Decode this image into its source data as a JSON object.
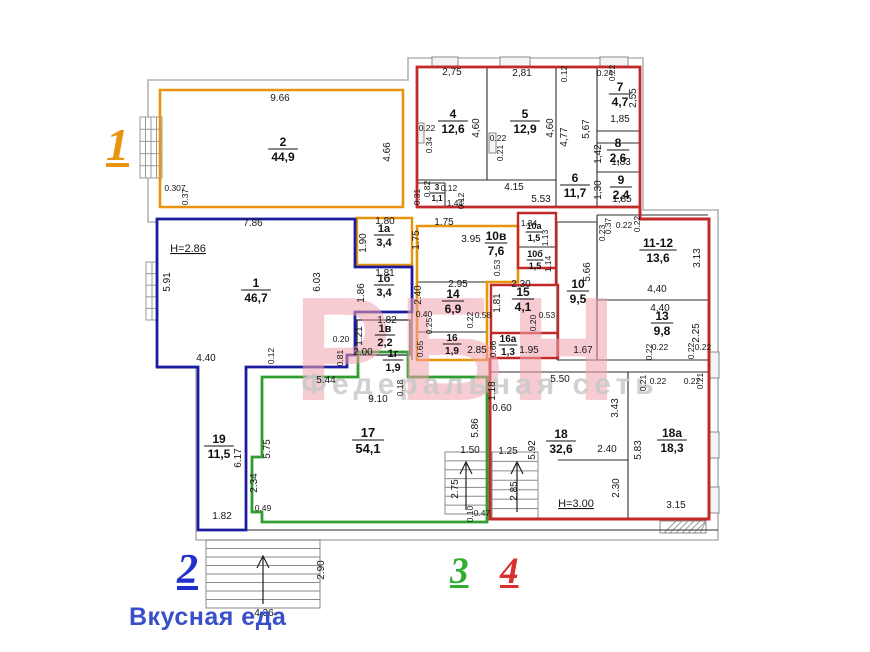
{
  "zones": [
    {
      "n": "1",
      "color": "#e8940c"
    },
    {
      "n": "2",
      "color": "#2230cc"
    },
    {
      "n": "3",
      "color": "#2fae2f"
    },
    {
      "n": "4",
      "color": "#d93030"
    }
  ],
  "brand": {
    "text": "Вкусная еда",
    "color": "#3a50c8"
  },
  "watermark": {
    "big": "РБН",
    "big_color": "#f2a2ae",
    "small": "Федеральная сеть",
    "small_color": "#c9c9c9"
  },
  "heights": [
    {
      "t": "H=2.86",
      "x": 188,
      "y": 252
    },
    {
      "t": "H=3.00",
      "x": 576,
      "y": 507
    }
  ],
  "rooms": [
    {
      "id": "2",
      "area": "44,9",
      "x": 283,
      "y": 146,
      "fs": 12
    },
    {
      "id": "1",
      "area": "46,7",
      "x": 256,
      "y": 287,
      "fs": 12
    },
    {
      "id": "1а",
      "area": "3,4",
      "x": 384,
      "y": 232,
      "fs": 11
    },
    {
      "id": "1б",
      "area": "3,4",
      "x": 384,
      "y": 282,
      "fs": 11
    },
    {
      "id": "1в",
      "area": "2,2",
      "x": 385,
      "y": 332,
      "fs": 11
    },
    {
      "id": "1г",
      "area": "1,9",
      "x": 393,
      "y": 357,
      "fs": 11
    },
    {
      "id": "3",
      "area": "1,1",
      "x": 437,
      "y": 190,
      "fs": 8
    },
    {
      "id": "4",
      "area": "12,6",
      "x": 453,
      "y": 118,
      "fs": 12
    },
    {
      "id": "5",
      "area": "12,9",
      "x": 525,
      "y": 118,
      "fs": 12
    },
    {
      "id": "6",
      "area": "11,7",
      "x": 575,
      "y": 182,
      "fs": 12
    },
    {
      "id": "7",
      "area": "4,7",
      "x": 620,
      "y": 91,
      "fs": 12
    },
    {
      "id": "8",
      "area": "2,6",
      "x": 618,
      "y": 147,
      "fs": 12
    },
    {
      "id": "9",
      "area": "2,4",
      "x": 621,
      "y": 184,
      "fs": 12
    },
    {
      "id": "10в",
      "area": "7,6",
      "x": 496,
      "y": 240,
      "fs": 12
    },
    {
      "id": "10а",
      "area": "1,5",
      "x": 534,
      "y": 229,
      "fs": 9
    },
    {
      "id": "10б",
      "area": "1,5",
      "x": 535,
      "y": 257,
      "fs": 9
    },
    {
      "id": "14",
      "area": "6,9",
      "x": 453,
      "y": 298,
      "fs": 12
    },
    {
      "id": "15",
      "area": "4,1",
      "x": 523,
      "y": 296,
      "fs": 12
    },
    {
      "id": "16",
      "area": "1,9",
      "x": 452,
      "y": 341,
      "fs": 10
    },
    {
      "id": "16а",
      "area": "1,3",
      "x": 508,
      "y": 342,
      "fs": 10
    },
    {
      "id": "10",
      "area": "9,5",
      "x": 578,
      "y": 288,
      "fs": 12
    },
    {
      "id": "11-12",
      "area": "13,6",
      "x": 658,
      "y": 247,
      "fs": 12
    },
    {
      "id": "13",
      "area": "9,8",
      "x": 662,
      "y": 320,
      "fs": 12
    },
    {
      "id": "17",
      "area": "54,1",
      "x": 368,
      "y": 437,
      "fs": 13
    },
    {
      "id": "19",
      "area": "11,5",
      "x": 219,
      "y": 443,
      "fs": 12
    },
    {
      "id": "18",
      "area": "32,6",
      "x": 561,
      "y": 438,
      "fs": 12
    },
    {
      "id": "18а",
      "area": "18,3",
      "x": 672,
      "y": 437,
      "fs": 12
    }
  ],
  "dims": [
    {
      "t": "9.66",
      "x": 280,
      "y": 101
    },
    {
      "t": "4.66",
      "x": 390,
      "y": 152,
      "r": 1
    },
    {
      "t": "0.307",
      "x": 175,
      "y": 191,
      "s": 1
    },
    {
      "t": "0.37",
      "x": 188,
      "y": 197,
      "r": 1,
      "s": 1
    },
    {
      "t": "2,75",
      "x": 452,
      "y": 75
    },
    {
      "t": "2,81",
      "x": 522,
      "y": 76
    },
    {
      "t": "4,60",
      "x": 479,
      "y": 128,
      "r": 1
    },
    {
      "t": "4,60",
      "x": 553,
      "y": 128,
      "r": 1
    },
    {
      "t": "0.22",
      "x": 427,
      "y": 131,
      "s": 1
    },
    {
      "t": "0.34",
      "x": 432,
      "y": 145,
      "r": 1,
      "s": 1
    },
    {
      "t": "0.22",
      "x": 498,
      "y": 141,
      "s": 1
    },
    {
      "t": "0.21",
      "x": 503,
      "y": 153,
      "r": 1,
      "s": 1
    },
    {
      "t": "4,77",
      "x": 567,
      "y": 137,
      "r": 1
    },
    {
      "t": "5,67",
      "x": 589,
      "y": 129,
      "r": 1
    },
    {
      "t": "4.15",
      "x": 514,
      "y": 190
    },
    {
      "t": "5.53",
      "x": 541,
      "y": 202
    },
    {
      "t": "0.24",
      "x": 605,
      "y": 76,
      "s": 1
    },
    {
      "t": "0.22",
      "x": 615,
      "y": 73,
      "r": 1,
      "s": 1
    },
    {
      "t": "0.12",
      "x": 567,
      "y": 74,
      "r": 1,
      "s": 1
    },
    {
      "t": "2,55",
      "x": 636,
      "y": 98,
      "r": 1
    },
    {
      "t": "1,85",
      "x": 620,
      "y": 122
    },
    {
      "t": "1,42",
      "x": 601,
      "y": 154,
      "r": 1
    },
    {
      "t": "1,83",
      "x": 621,
      "y": 165
    },
    {
      "t": "1,30",
      "x": 601,
      "y": 190,
      "r": 1
    },
    {
      "t": "1,85",
      "x": 622,
      "y": 202
    },
    {
      "t": "0.82",
      "x": 430,
      "y": 189,
      "r": 1,
      "s": 1
    },
    {
      "t": "0.31",
      "x": 420,
      "y": 197,
      "r": 1,
      "s": 1
    },
    {
      "t": "0.12",
      "x": 449,
      "y": 191,
      "s": 1
    },
    {
      "t": "0.12",
      "x": 464,
      "y": 201,
      "r": 1,
      "s": 1
    },
    {
      "t": "1,44",
      "x": 455,
      "y": 206,
      "s": 1
    },
    {
      "t": "7.86",
      "x": 253,
      "y": 226
    },
    {
      "t": "5.91",
      "x": 170,
      "y": 282,
      "r": 1
    },
    {
      "t": "6.03",
      "x": 320,
      "y": 282,
      "r": 1
    },
    {
      "t": "4.40",
      "x": 206,
      "y": 361
    },
    {
      "t": "0.12",
      "x": 274,
      "y": 356,
      "r": 1,
      "s": 1
    },
    {
      "t": "0.20",
      "x": 341,
      "y": 342,
      "s": 1
    },
    {
      "t": "0.81",
      "x": 343,
      "y": 358,
      "r": 1,
      "s": 1
    },
    {
      "t": "1.80",
      "x": 385,
      "y": 224
    },
    {
      "t": "1.90",
      "x": 366,
      "y": 243,
      "r": 1
    },
    {
      "t": "1.81",
      "x": 385,
      "y": 276
    },
    {
      "t": "1.86",
      "x": 364,
      "y": 293,
      "r": 1
    },
    {
      "t": "1.82",
      "x": 387,
      "y": 323
    },
    {
      "t": "1.21",
      "x": 362,
      "y": 336,
      "r": 1
    },
    {
      "t": "2.00",
      "x": 363,
      "y": 355
    },
    {
      "t": "1.75",
      "x": 444,
      "y": 225
    },
    {
      "t": "1.75",
      "x": 419,
      "y": 240,
      "r": 1
    },
    {
      "t": "3.95",
      "x": 471,
      "y": 242
    },
    {
      "t": "0.53",
      "x": 500,
      "y": 268,
      "r": 1,
      "s": 1
    },
    {
      "t": "1.34",
      "x": 529,
      "y": 226,
      "s": 1
    },
    {
      "t": "1.13",
      "x": 548,
      "y": 238,
      "r": 1,
      "s": 1
    },
    {
      "t": "1.14",
      "x": 551,
      "y": 264,
      "r": 1,
      "s": 1
    },
    {
      "t": "2.95",
      "x": 458,
      "y": 287
    },
    {
      "t": "2.40",
      "x": 421,
      "y": 295,
      "r": 1
    },
    {
      "t": "0.40",
      "x": 424,
      "y": 317,
      "s": 1
    },
    {
      "t": "0.25",
      "x": 432,
      "y": 326,
      "r": 1,
      "s": 1
    },
    {
      "t": "0.22",
      "x": 473,
      "y": 320,
      "r": 1,
      "s": 1
    },
    {
      "t": "0.58",
      "x": 483,
      "y": 318,
      "s": 1
    },
    {
      "t": "0.65",
      "x": 423,
      "y": 349,
      "r": 1,
      "s": 1
    },
    {
      "t": "2.85",
      "x": 477,
      "y": 353
    },
    {
      "t": "2.30",
      "x": 521,
      "y": 287
    },
    {
      "t": "1.81",
      "x": 500,
      "y": 303,
      "r": 1
    },
    {
      "t": "0.20",
      "x": 536,
      "y": 323,
      "r": 1,
      "s": 1
    },
    {
      "t": "0.53",
      "x": 547,
      "y": 318,
      "s": 1
    },
    {
      "t": "1.95",
      "x": 529,
      "y": 353
    },
    {
      "t": "0.66",
      "x": 496,
      "y": 349,
      "r": 1,
      "s": 1
    },
    {
      "t": "5.66",
      "x": 590,
      "y": 272,
      "r": 1
    },
    {
      "t": "1.67",
      "x": 583,
      "y": 353
    },
    {
      "t": "0.23",
      "x": 605,
      "y": 233,
      "r": 1,
      "s": 1
    },
    {
      "t": "0.37",
      "x": 611,
      "y": 226,
      "r": 1,
      "s": 1
    },
    {
      "t": "0.22",
      "x": 624,
      "y": 228,
      "s": 1
    },
    {
      "t": "0.22",
      "x": 640,
      "y": 224,
      "r": 1,
      "s": 1
    },
    {
      "t": "3.13",
      "x": 700,
      "y": 258,
      "r": 1
    },
    {
      "t": "4,40",
      "x": 657,
      "y": 292
    },
    {
      "t": "4,40",
      "x": 660,
      "y": 311
    },
    {
      "t": "2.25",
      "x": 699,
      "y": 333,
      "r": 1
    },
    {
      "t": "0.22",
      "x": 660,
      "y": 350,
      "s": 1
    },
    {
      "t": "0.22",
      "x": 652,
      "y": 352,
      "r": 1,
      "s": 1
    },
    {
      "t": "0.22",
      "x": 694,
      "y": 351,
      "r": 1,
      "s": 1
    },
    {
      "t": "0.22",
      "x": 703,
      "y": 350,
      "s": 1
    },
    {
      "t": "5.44",
      "x": 326,
      "y": 383
    },
    {
      "t": "9.10",
      "x": 378,
      "y": 402
    },
    {
      "t": "0.18",
      "x": 403,
      "y": 388,
      "r": 1,
      "s": 1
    },
    {
      "t": "5.75",
      "x": 270,
      "y": 449,
      "r": 1
    },
    {
      "t": "2.34",
      "x": 257,
      "y": 483,
      "r": 1
    },
    {
      "t": "0.49",
      "x": 263,
      "y": 511,
      "s": 1
    },
    {
      "t": "5.86",
      "x": 478,
      "y": 428,
      "r": 1
    },
    {
      "t": "6.17",
      "x": 241,
      "y": 458,
      "r": 1
    },
    {
      "t": "1.82",
      "x": 222,
      "y": 519
    },
    {
      "t": "1.50",
      "x": 470,
      "y": 453
    },
    {
      "t": "2.75",
      "x": 458,
      "y": 489,
      "r": 1
    },
    {
      "t": "1.25",
      "x": 508,
      "y": 454
    },
    {
      "t": "2.85",
      "x": 517,
      "y": 491,
      "r": 1
    },
    {
      "t": "0.10",
      "x": 473,
      "y": 514,
      "r": 1,
      "s": 1
    },
    {
      "t": "0.47",
      "x": 482,
      "y": 516,
      "s": 1
    },
    {
      "t": "5.50",
      "x": 560,
      "y": 382
    },
    {
      "t": "1.18",
      "x": 495,
      "y": 391,
      "r": 1
    },
    {
      "t": "0.60",
      "x": 502,
      "y": 411
    },
    {
      "t": "5.92",
      "x": 535,
      "y": 450,
      "r": 1
    },
    {
      "t": "3.43",
      "x": 618,
      "y": 408,
      "r": 1
    },
    {
      "t": "2.40",
      "x": 607,
      "y": 452
    },
    {
      "t": "2.30",
      "x": 619,
      "y": 488,
      "r": 1
    },
    {
      "t": "5.83",
      "x": 641,
      "y": 450,
      "r": 1
    },
    {
      "t": "3.15",
      "x": 676,
      "y": 508
    },
    {
      "t": "0.21",
      "x": 646,
      "y": 383,
      "r": 1,
      "s": 1
    },
    {
      "t": "0.22",
      "x": 658,
      "y": 384,
      "s": 1
    },
    {
      "t": "0.22",
      "x": 692,
      "y": 384,
      "s": 1
    },
    {
      "t": "0.21",
      "x": 703,
      "y": 381,
      "r": 1,
      "s": 1
    },
    {
      "t": "2.90",
      "x": 324,
      "y": 570,
      "r": 1
    },
    {
      "t": "4.36",
      "x": 264,
      "y": 616
    }
  ],
  "plan": {
    "outer": "M148,80 H408 V58 H643 V210 H718 V540 H196 V368 H157 V222 H148 Z",
    "outlines": [
      {
        "c": "#e8940c",
        "w": 2.6,
        "d": "M160,90 H403 V207 H160 Z"
      },
      {
        "c": "#e8940c",
        "w": 2.4,
        "d": "M357,218 H412 V265 H357 Z"
      },
      {
        "c": "#e8940c",
        "w": 2.6,
        "d": "M417,226 H518 V282 H487 V360 H417 Z"
      },
      {
        "c": "#1c1c9e",
        "w": 2.8,
        "d": "M157,219 H355 V267 H412 V312 H355 V355 H347 V367 H246 V530 H198 V367 H157 Z"
      },
      {
        "c": "#2f9e2f",
        "w": 2.8,
        "d": "M358,352 H408 V377 H487 V522 H262 V512 H252 V457 H262 V377 H358 Z"
      },
      {
        "c": "#c22a2a",
        "w": 2.8,
        "d": "M417,67 H640 V207 H417 Z"
      },
      {
        "c": "#c22a2a",
        "w": 2.4,
        "d": "M518,213 H556 V268 H518 Z"
      },
      {
        "c": "#c22a2a",
        "w": 2.4,
        "d": "M491,285 H558 V358 H491 Z"
      },
      {
        "c": "#c22a2a",
        "w": 2.4,
        "d": "M491,333 H558"
      },
      {
        "c": "#c22a2a",
        "w": 2.4,
        "d": "M556,268 V285"
      },
      {
        "c": "#c22a2a",
        "w": 3.0,
        "d": "M640,207 V219 H709 V519 H490 V358"
      }
    ],
    "walls": [
      [
        487,
        67,
        487,
        180
      ],
      [
        556,
        67,
        556,
        207
      ],
      [
        417,
        180,
        556,
        180
      ],
      [
        597,
        67,
        597,
        207
      ],
      [
        597,
        131,
        640,
        131
      ],
      [
        597,
        143,
        640,
        143
      ],
      [
        597,
        172,
        640,
        172
      ],
      [
        417,
        183,
        445,
        183
      ],
      [
        445,
        183,
        445,
        207
      ],
      [
        417,
        282,
        518,
        282
      ],
      [
        518,
        247,
        556,
        247
      ],
      [
        418,
        332,
        487,
        332
      ],
      [
        412,
        218,
        412,
        360
      ],
      [
        557,
        222,
        597,
        222
      ],
      [
        557,
        222,
        557,
        360
      ],
      [
        597,
        222,
        597,
        360
      ],
      [
        557,
        360,
        597,
        360
      ],
      [
        597,
        215,
        708,
        215
      ],
      [
        597,
        215,
        597,
        360
      ],
      [
        597,
        300,
        708,
        300
      ],
      [
        597,
        360,
        708,
        360
      ],
      [
        628,
        372,
        628,
        519
      ],
      [
        558,
        460,
        628,
        460
      ],
      [
        490,
        372,
        709,
        372
      ],
      [
        246,
        530,
        718,
        530
      ]
    ],
    "black_boxes": [
      {
        "x": 357,
        "y": 320,
        "w": 53,
        "h": 35
      }
    ],
    "wallmarks": [
      {
        "x": 710,
        "y": 352,
        "w": 9,
        "h": 26
      },
      {
        "x": 710,
        "y": 432,
        "w": 9,
        "h": 26
      },
      {
        "x": 710,
        "y": 487,
        "w": 9,
        "h": 26
      },
      {
        "x": 432,
        "y": 57,
        "w": 26,
        "h": 9
      },
      {
        "x": 500,
        "y": 57,
        "w": 30,
        "h": 9
      },
      {
        "x": 600,
        "y": 57,
        "w": 28,
        "h": 9
      },
      {
        "x": 417,
        "y": 123,
        "w": 7,
        "h": 20
      },
      {
        "x": 489,
        "y": 133,
        "w": 7,
        "h": 20
      }
    ],
    "grids": [
      {
        "x": 140,
        "y": 117,
        "w": 22,
        "h": 61,
        "cols": 3,
        "rows": 4
      },
      {
        "x": 146,
        "y": 262,
        "w": 12,
        "h": 58,
        "cols": 1,
        "rows": 4
      }
    ],
    "hatches": [
      {
        "x": 660,
        "y": 521,
        "w": 46,
        "h": 12
      }
    ],
    "stairs": [
      {
        "x": 206,
        "y": 540,
        "w": 114,
        "h": 68,
        "treads": 7,
        "ax": 263,
        "ay1": 604,
        "ay2": 556
      },
      {
        "x": 445,
        "y": 452,
        "w": 42,
        "h": 62,
        "treads": 6,
        "ax": 466,
        "ay1": 510,
        "ay2": 462
      },
      {
        "x": 492,
        "y": 452,
        "w": 46,
        "h": 66,
        "treads": 6,
        "ax": 517,
        "ay1": 512,
        "ay2": 462
      }
    ]
  }
}
